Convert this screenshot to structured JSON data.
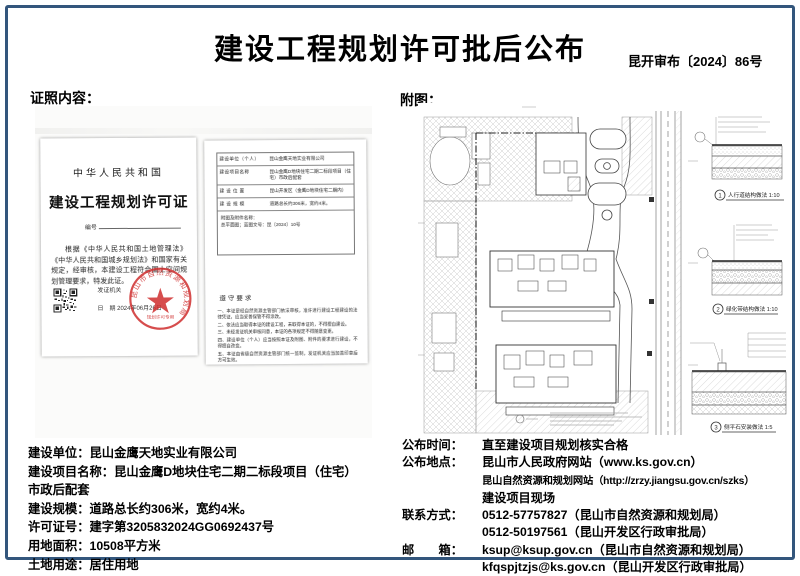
{
  "page": {
    "title": "建设工程规划许可批后公布",
    "doc_number": "昆开审布〔2024〕86号"
  },
  "sections": {
    "left_label": "证照内容：",
    "right_label": "附图："
  },
  "certificate": {
    "country": "中华人民共和国",
    "title": "建设工程规划许可证",
    "number_label": "编号",
    "body": "根据《中华人民共和国土地管理法》《中华人民共和国城乡规划法》和国家有关规定，经审核，本建设工程符合国土空间规划管理要求，特发此证。",
    "issuer_label": "发证机关",
    "date_label": "日　期",
    "date_value": "2024年06月26日",
    "seal_ring_text": "昆山市自然资源和规划局",
    "seal_sub_text": "规划许可专用"
  },
  "permit_detail": {
    "rows": [
      {
        "label": "建设单位（个人）",
        "value": "昆山金鹰天地实业有限公司"
      },
      {
        "label": "建设项目名称",
        "value": "昆山金鹰D地块住宅二期二标段项目（住宅）市政后配套"
      },
      {
        "label": "建 设 位 置",
        "value": "昆山开发区（金鹰D地块住宅二期内）"
      },
      {
        "label": "建 设 规 模",
        "value": "道路总长约306米，宽约4米。"
      }
    ],
    "attachment_line1": "附图及附件名称：",
    "attachment_line2": "总平面图；蓝图文号：昆〔2024〕10号",
    "rules_title": "遵守要求",
    "rules": [
      "一、本证是经自然资源主管部门依法审核，准许进行建设工程建设的法律凭证，应当妥善保管不得涂改。",
      "二、依法应当取得本证的建设工程，未取得本证的，不得擅自建设。",
      "三、未经发证机关审核同意，本证的各项规定不得随意变更。",
      "四、建设单位（个人）应当按照本证及附图、附件的要求进行建设，不得擅自改变。",
      "五、本证由省级自然资源主管部门统一监制，发证机关应当加盖印章后方可生效。"
    ]
  },
  "site_plan": {
    "details": [
      {
        "num": "1",
        "caption": "人行道结构做法 1:10"
      },
      {
        "num": "2",
        "caption": "绿化带结构做法 1:10"
      },
      {
        "num": "3",
        "caption": "侧平石安装做法 1:5"
      }
    ]
  },
  "info_left": {
    "lines": [
      {
        "label": "建设单位：",
        "value": "昆山金鹰天地实业有限公司"
      },
      {
        "label": "建设项目名称：",
        "value": "昆山金鹰D地块住宅二期二标段项目（住宅）"
      },
      {
        "label": "",
        "value": "市政后配套"
      },
      {
        "label": "建设规模：",
        "value": "道路总长约306米，宽约4米。"
      },
      {
        "label": "许可证号：",
        "value": "建字第3205832024GG0692437号"
      },
      {
        "label": "用地面积：",
        "value": "10508平方米"
      },
      {
        "label": "土地用途：",
        "value": "居住用地"
      }
    ]
  },
  "info_right": {
    "lines": [
      {
        "label": "公布时间：",
        "value": "直至建设项目规划核实合格"
      },
      {
        "label": "公布地点：",
        "value": "昆山市人民政府网站（www.ks.gov.cn）"
      },
      {
        "label": "",
        "value": "昆山自然资源和规划网站（http://zrzy.jiangsu.gov.cn/szks）"
      },
      {
        "label": "",
        "value": "建设项目现场"
      },
      {
        "label": "联系方式：",
        "value": "0512-57757827（昆山市自然资源和规划局）"
      },
      {
        "label": "",
        "value": "0512-50197561（昆山开发区行政审批局）"
      },
      {
        "label": "邮　　箱：",
        "value": "ksup@ksup.gov.cn（昆山市自然资源和规划局）"
      },
      {
        "label": "",
        "value": "kfqspjtzjs@ks.gov.cn（昆山开发区行政审批局）"
      }
    ]
  }
}
